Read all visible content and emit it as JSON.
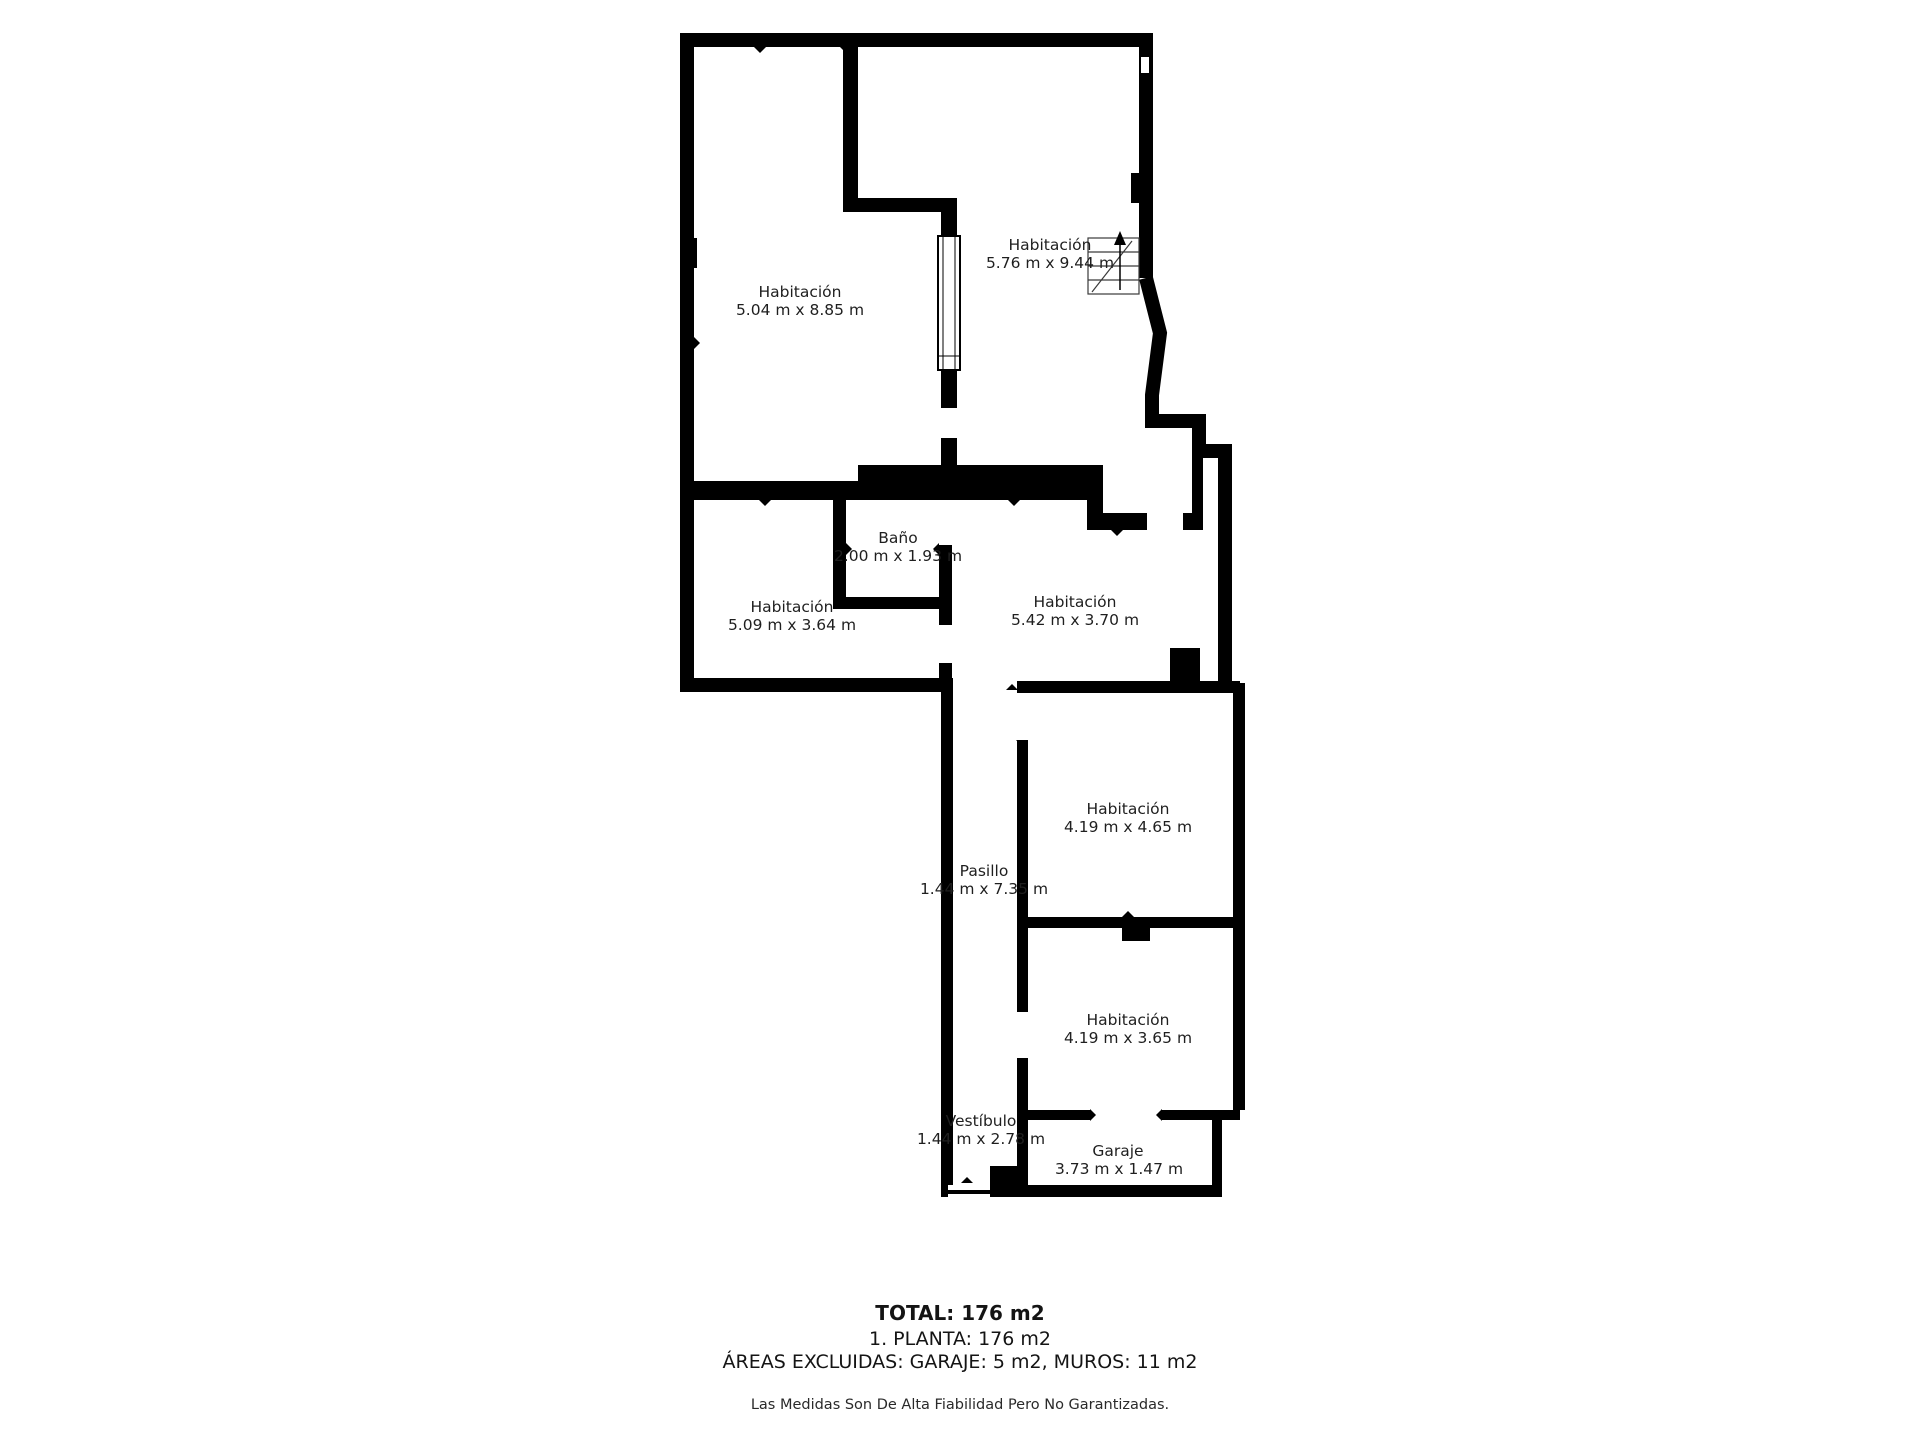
{
  "floorplan": {
    "rooms": {
      "hab_top_left": {
        "name": "Habitación",
        "dims": "5.04 m x 8.85 m"
      },
      "hab_top_right": {
        "name": "Habitación",
        "dims": "5.76 m x 9.44 m"
      },
      "bano": {
        "name": "Baño",
        "dims": "2.00 m x 1.93 m"
      },
      "hab_mid_left": {
        "name": "Habitación",
        "dims": "5.09 m x 3.64 m"
      },
      "hab_mid_center": {
        "name": "Habitación",
        "dims": "5.42 m x 3.70 m"
      },
      "pasillo": {
        "name": "Pasillo",
        "dims": "1.44 m x 7.35 m"
      },
      "hab_right_upper": {
        "name": "Habitación",
        "dims": "4.19 m x 4.65 m"
      },
      "hab_right_lower": {
        "name": "Habitación",
        "dims": "4.19 m x 3.65 m"
      },
      "vestibulo": {
        "name": "Vestíbulo",
        "dims": "1.44 m x 2.78 m"
      },
      "garaje": {
        "name": "Garaje",
        "dims": "3.73 m x 1.47 m"
      }
    },
    "summary": {
      "total": "TOTAL: 176 m2",
      "planta": "1. PLANTA: 176 m2",
      "excluded": "ÁREAS EXCLUIDAS: GARAJE: 5 m2, MUROS: 11 m2",
      "disclaimer": "Las Medidas Son De Alta Fiabilidad Pero No Garantizadas."
    },
    "colors": {
      "wall": "#000000",
      "background": "#ffffff",
      "text": "#1f1f1f"
    }
  }
}
